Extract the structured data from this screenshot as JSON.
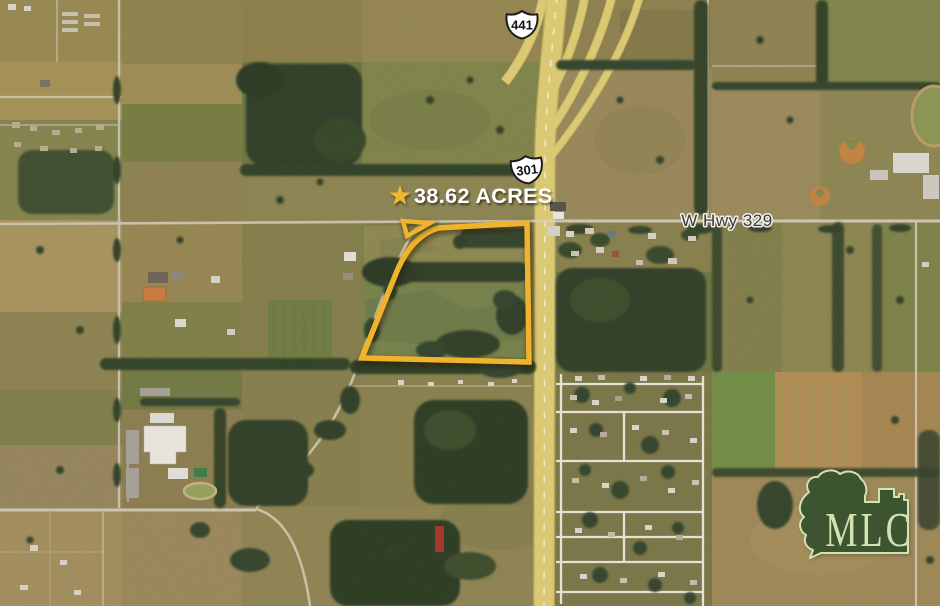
{
  "map": {
    "type": "aerial-listing-map",
    "annotations": {
      "acreage_label": "38.62 ACRES",
      "acreage_text_color": "#FFFFFF",
      "boundary_color": "#F0B42C",
      "star_color": "#EFB62F",
      "route_shields": [
        {
          "route": "441"
        },
        {
          "route": "301"
        }
      ],
      "road_label": "W Hwy 329",
      "logo_text": "MLC",
      "logo_fill": "#3D5430",
      "logo_outline": "#D2E2B1"
    }
  }
}
